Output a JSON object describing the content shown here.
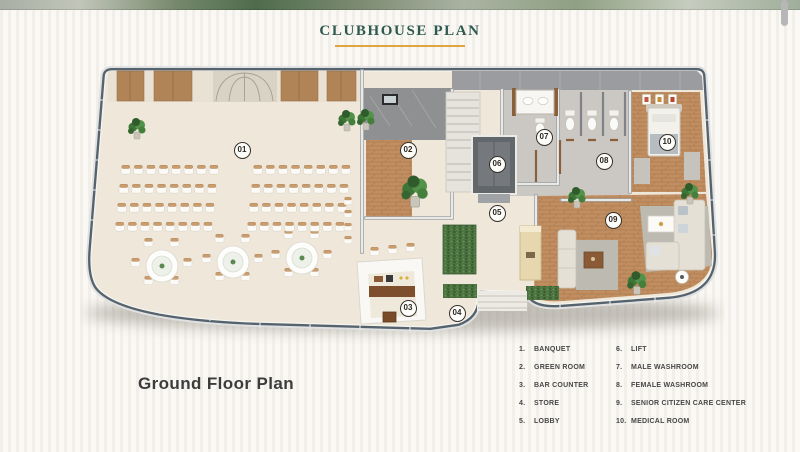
{
  "header": {
    "title": "CLUBHOUSE PLAN"
  },
  "floor_label": "Ground Floor Plan",
  "legend": {
    "columns": [
      [
        {
          "num": "1.",
          "label": "BANQUET"
        },
        {
          "num": "2.",
          "label": "GREEN ROOM"
        },
        {
          "num": "3.",
          "label": "BAR COUNTER"
        },
        {
          "num": "4.",
          "label": "STORE"
        },
        {
          "num": "5.",
          "label": "LOBBY"
        }
      ],
      [
        {
          "num": "6.",
          "label": "LIFT"
        },
        {
          "num": "7.",
          "label": "MALE WASHROOM"
        },
        {
          "num": "8.",
          "label": "FEMALE WASHROOM"
        },
        {
          "num": "9.",
          "label": "SENIOR CITIZEN CARE CENTER"
        },
        {
          "num": "10.",
          "label": "MEDICAL ROOM"
        }
      ]
    ]
  },
  "plan": {
    "markers": [
      {
        "num": "01",
        "x": 242,
        "y": 150
      },
      {
        "num": "02",
        "x": 408,
        "y": 150
      },
      {
        "num": "03",
        "x": 408,
        "y": 308
      },
      {
        "num": "04",
        "x": 457,
        "y": 313
      },
      {
        "num": "05",
        "x": 497,
        "y": 213
      },
      {
        "num": "06",
        "x": 497,
        "y": 164
      },
      {
        "num": "07",
        "x": 544,
        "y": 137
      },
      {
        "num": "08",
        "x": 604,
        "y": 161
      },
      {
        "num": "09",
        "x": 613,
        "y": 220
      },
      {
        "num": "10",
        "x": 667,
        "y": 142
      }
    ]
  },
  "colors": {
    "title": "#2d594e",
    "title_underline": "#dfa742",
    "legend_text": "#474747",
    "floor_label": "#3c3c3c",
    "glass_wall": "#55636f",
    "floor_cream": "#efe8da",
    "wood": "#c08e61",
    "plant_green": "#3e7637"
  }
}
